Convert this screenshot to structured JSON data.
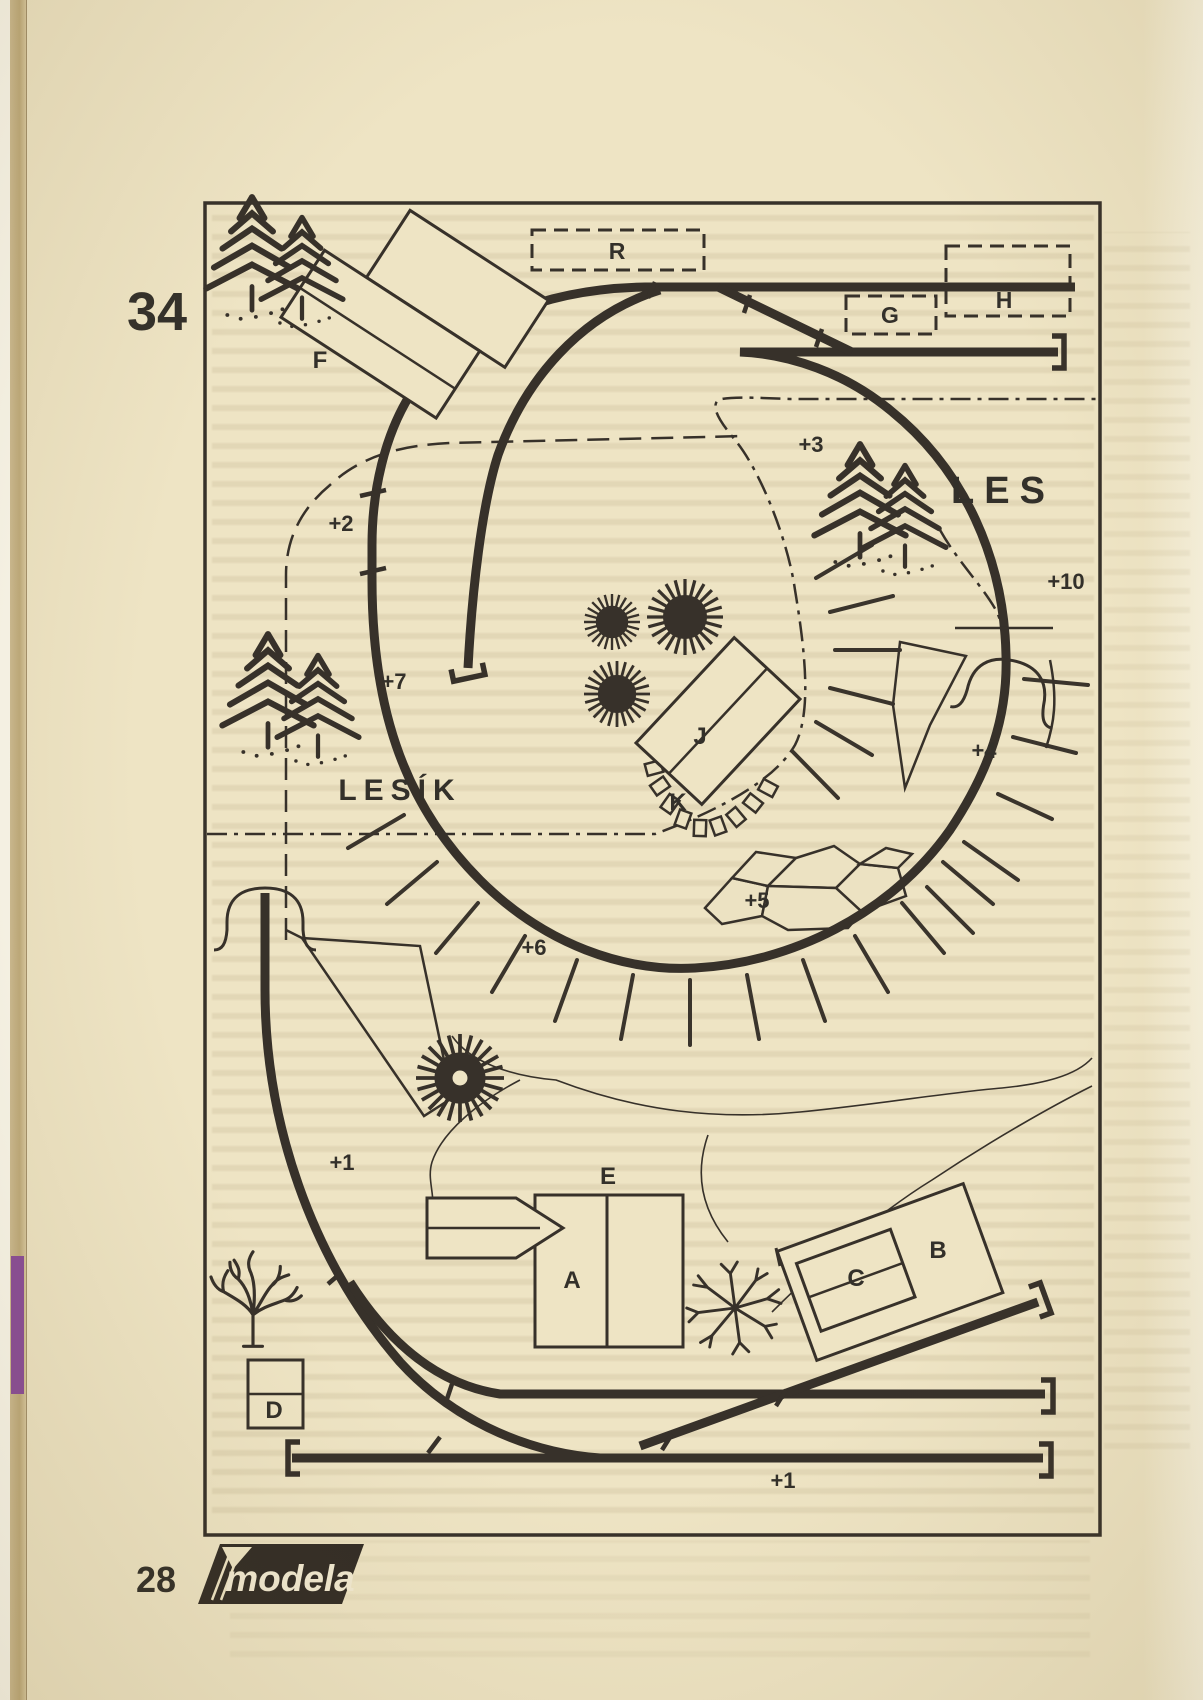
{
  "page": {
    "layout_number": "34",
    "page_number": "28",
    "publisher_logo": "modela"
  },
  "plan": {
    "forest": {
      "large": "LES",
      "small": "LESÍK"
    },
    "hidden_tracks": {
      "r": "R",
      "g": "G",
      "h": "H"
    },
    "buildings": {
      "a": "A",
      "b": "B",
      "c": "C",
      "d": "D",
      "e": "E",
      "f": "F",
      "j": "J",
      "k": "K"
    },
    "elevations": {
      "plus1_curve": "+1",
      "plus1_yard": "+1",
      "plus2": "+2",
      "plus3": "+3",
      "plus4": "+4",
      "plus5": "+5",
      "plus6": "+6",
      "plus7": "+7",
      "plus10": "+10"
    },
    "colors": {
      "paper": "#eee4c4",
      "ink": "#37312a",
      "spine_purple": "#8a4d99"
    }
  }
}
